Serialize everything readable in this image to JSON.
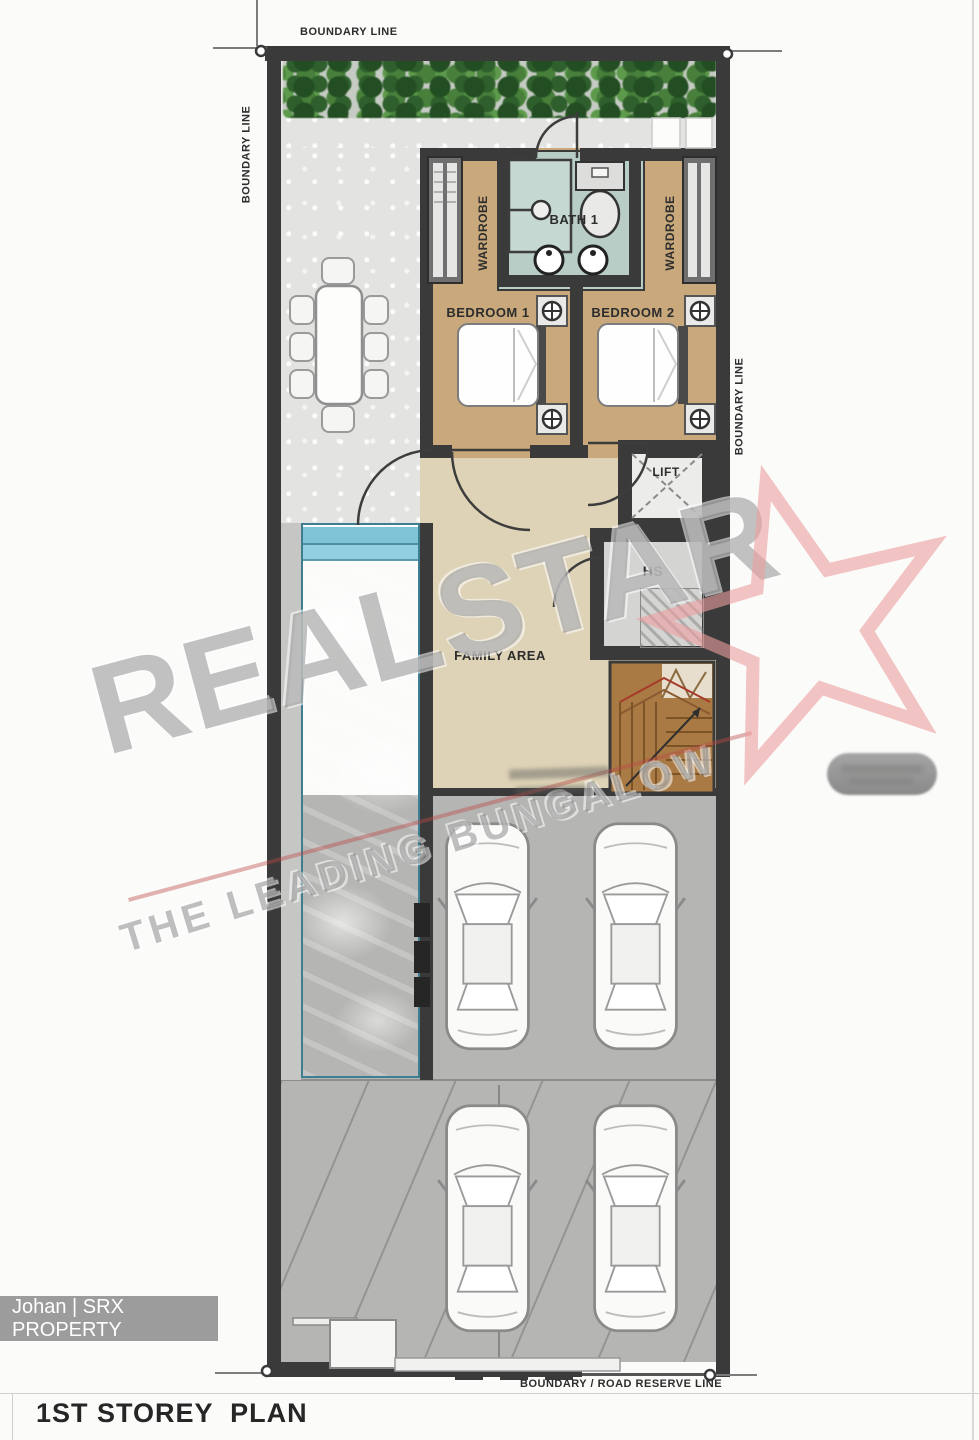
{
  "page": {
    "title": "1ST STOREY  PLAN",
    "agent_badge": "Johan | SRX PROPERTY"
  },
  "boundaries": {
    "top": "BOUNDARY LINE",
    "left": "BOUNDARY LINE",
    "right": "BOUNDARY LINE",
    "bottom": "BOUNDARY / ROAD RESERVE LINE"
  },
  "rooms": {
    "bath1": "BATH 1",
    "wardrobe": "WARDROBE",
    "bedroom1": "BEDROOM 1",
    "bedroom2": "BEDROOM 2",
    "lift": "LIFT",
    "hs": "HS",
    "family_area": "FAMILY AREA"
  },
  "features": {
    "pool": "swimming pool",
    "cars_parked": 4,
    "dining_seats": 8,
    "hedge": "landscaped planting strip"
  },
  "watermark": {
    "brand": "REALSTAR",
    "tagline": "THE LEADING BUNGALOW",
    "brand_color": "#8e8e8e",
    "star_color": "#ec9f9f"
  },
  "colors": {
    "bedroom_floor": "#c9a97b",
    "family_floor": "#ded3b6",
    "bath_floor": "#b9cdc7",
    "pool_water": "#a6dff0",
    "garage_floor": "#b5b5b3",
    "patio_floor": "#e2e2e0",
    "wall": "#3a3a3a",
    "stairs": "#a97a44"
  }
}
